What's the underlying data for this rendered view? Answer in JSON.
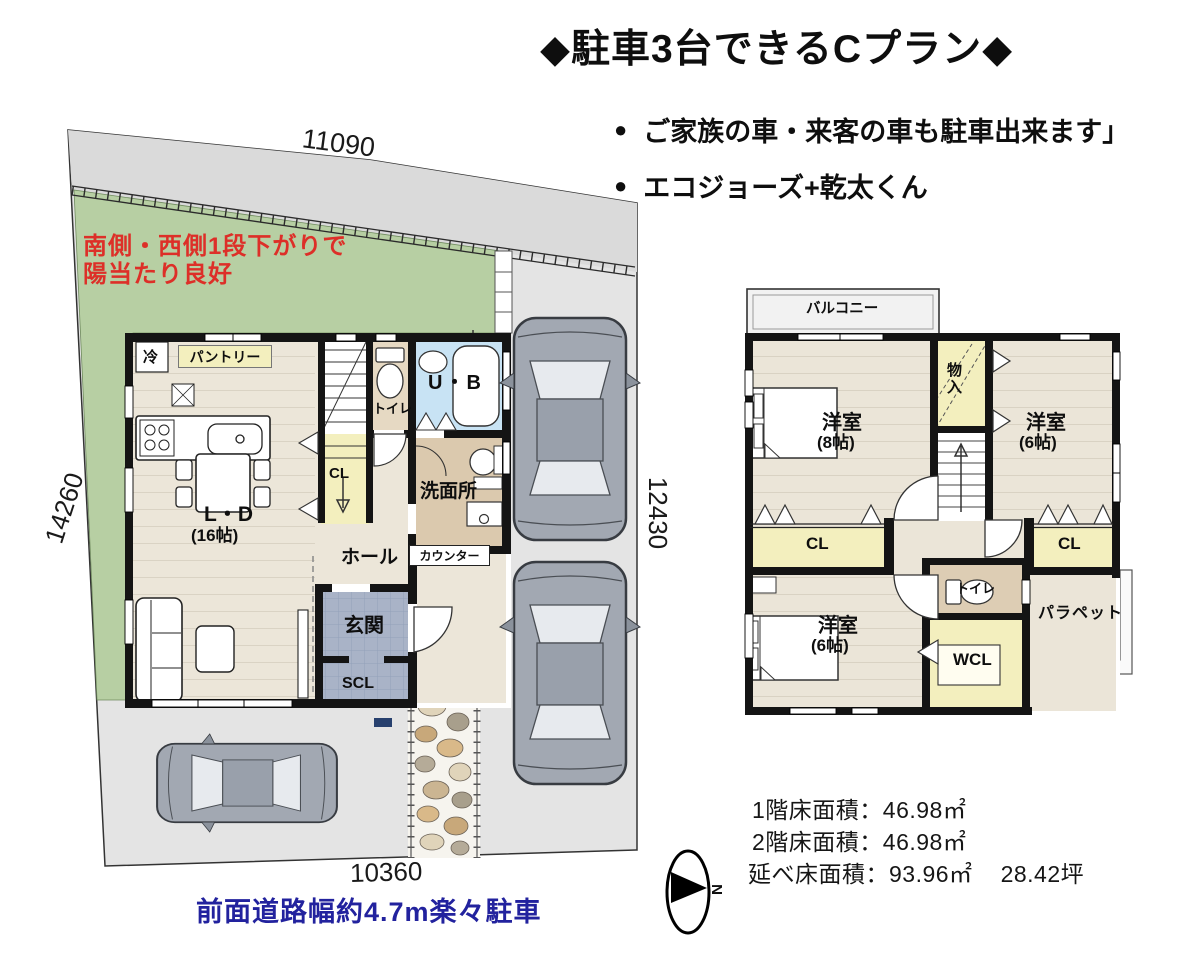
{
  "header": {
    "title": "◆駐車3台できるCプラン◆",
    "bullet_marker": "●",
    "bullets": [
      "ご家族の車・来客の車も駐車出来ます」",
      "エコジョーズ+乾太くん"
    ]
  },
  "site": {
    "dim_top": "11090",
    "dim_left": "14260",
    "dim_right": "12430",
    "dim_bottom": "10360",
    "grade_note_line1": "南側・西側1段下がりで",
    "grade_note_line2": "陽当たり良好",
    "road_note": "前面道路幅約4.7m楽々駐車"
  },
  "floor1": {
    "fridge": "冷",
    "pantry": "パントリー",
    "toilet": "トイレ",
    "bath": "U・B",
    "stair_closet": "CL",
    "washroom": "洗面所",
    "counter": "カウンター",
    "hall": "ホール",
    "living_label": "L・D",
    "living_size": "(16帖)",
    "entrance": "玄関",
    "shoe_closet": "SCL"
  },
  "floor2": {
    "balcony": "バルコニー",
    "room8_label": "洋室",
    "room8_size": "(8帖)",
    "storage": "物入",
    "room6a_label": "洋室",
    "room6a_size": "(6帖)",
    "closet_left": "CL",
    "closet_right": "CL",
    "toilet": "トイレ",
    "room6b_label": "洋室",
    "room6b_size": "(6帖)",
    "walkin_closet": "WCL",
    "parapet": "パラペット"
  },
  "areas": {
    "line1": "1階床面積：46.98㎡",
    "line2": "2階床面積：46.98㎡",
    "line3": "延べ床面積：93.96㎡",
    "tsubo": "28.42坪"
  },
  "compass": {
    "north": "N"
  },
  "colors": {
    "site_grey": "#e4e4e4",
    "upper_strip_grey": "#dadada",
    "garden_green": "#b7cfa3",
    "floor_cream": "#ece6d9",
    "closet_yellow": "#f3efbe",
    "bath_blue": "#c8e3f4",
    "wash_beige": "#dbc9ae",
    "entry_slate": "#a9b3c7",
    "wall_black": "#141414",
    "car_grey": "#a2a8b2",
    "red_note": "#dd2f28",
    "road_blue": "#22229e"
  }
}
